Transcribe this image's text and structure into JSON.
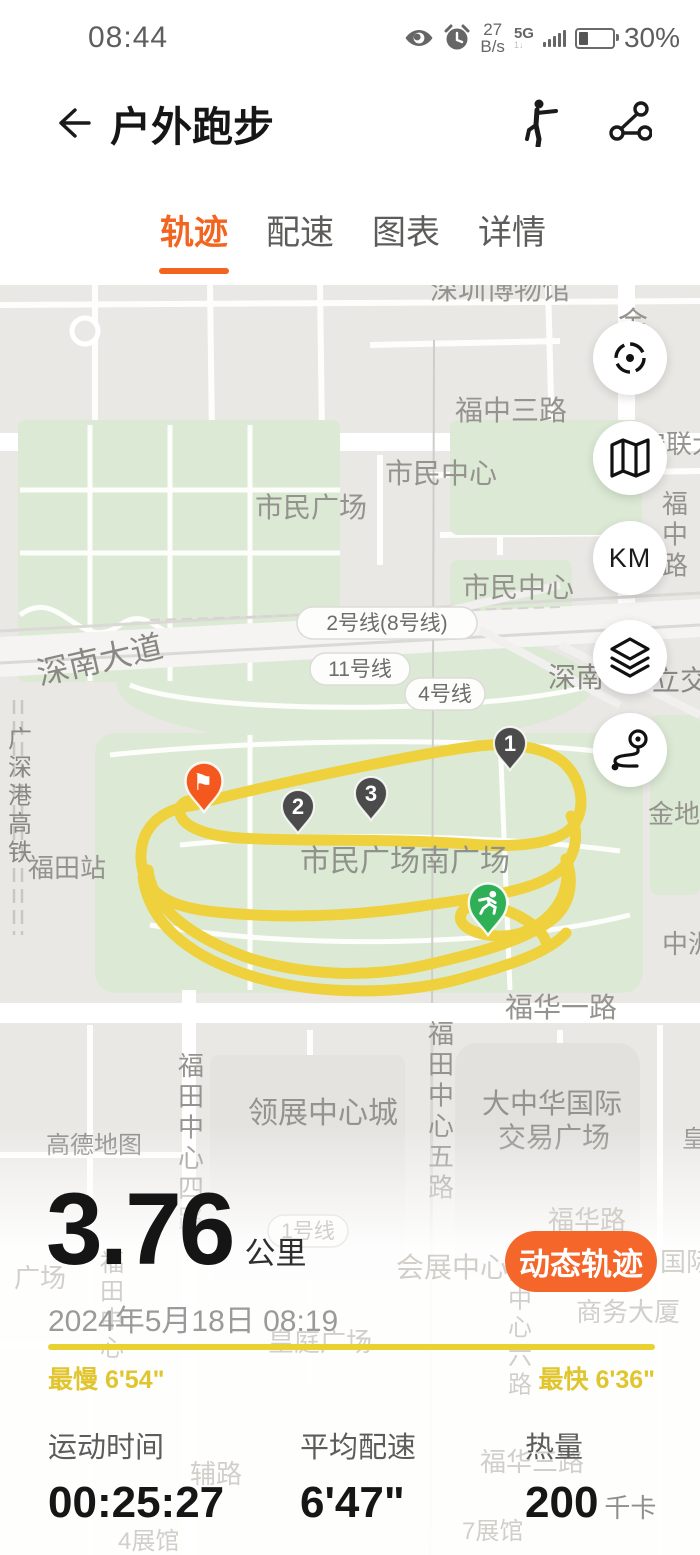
{
  "colors": {
    "accent": "#f2641f",
    "button_orange": "#f4662a",
    "track_yellow": "#eed13d",
    "pace_yellow": "#e0c52e",
    "pin_dark": "#4b4b4b",
    "pin_green": "#2fb057",
    "pin_flag": "#f5581f",
    "map_label": "#95938e",
    "map_label_faint": "#d2cfca"
  },
  "status_bar": {
    "time": "08:44",
    "net_value": "27",
    "net_unit": "B/s",
    "net_type": "5G",
    "battery_percent": "30%"
  },
  "header": {
    "title": "户外跑步"
  },
  "tabs": [
    {
      "label": "轨迹",
      "active": true
    },
    {
      "label": "配速",
      "active": false
    },
    {
      "label": "图表",
      "active": false
    },
    {
      "label": "详情",
      "active": false
    }
  ],
  "map": {
    "attribution": "高德地图",
    "km_button_label": "KM",
    "labels": [
      {
        "text": "深圳博物馆",
        "x": 430,
        "y": 14,
        "size": 28
      },
      {
        "text": "金",
        "x": 618,
        "y": 48,
        "size": 30
      },
      {
        "text": "福中三路",
        "x": 455,
        "y": 135,
        "size": 28
      },
      {
        "text": "安联大",
        "x": 640,
        "y": 168,
        "size": 26
      },
      {
        "text": "市民广场",
        "x": 255,
        "y": 232,
        "size": 28
      },
      {
        "text": "市民中心",
        "x": 385,
        "y": 198,
        "size": 28
      },
      {
        "text": "市民中心",
        "x": 462,
        "y": 312,
        "size": 28
      },
      {
        "text": "福中路",
        "x": 662,
        "y": 228,
        "size": 26,
        "vertical": true
      },
      {
        "text": "深南大道",
        "x": 40,
        "y": 400,
        "size": 32,
        "rotate": -13,
        "color": "#8a8883"
      },
      {
        "text": "深南",
        "x": 548,
        "y": 402,
        "size": 28,
        "color": "#8a8883"
      },
      {
        "text": "立交",
        "x": 652,
        "y": 405,
        "size": 28,
        "color": "#8a8883"
      },
      {
        "text": "广深港高铁",
        "x": 8,
        "y": 462,
        "size": 24,
        "vertical": true,
        "color": "#8a8883"
      },
      {
        "text": "福田站",
        "x": 28,
        "y": 592,
        "size": 26
      },
      {
        "text": "市民广场南广场",
        "x": 300,
        "y": 586,
        "size": 30,
        "color": "#8f928b"
      },
      {
        "text": "金地",
        "x": 648,
        "y": 538,
        "size": 26
      },
      {
        "text": "中洲",
        "x": 662,
        "y": 668,
        "size": 26
      },
      {
        "text": "福华一路",
        "x": 505,
        "y": 732,
        "size": 28
      },
      {
        "text": "福田中心四路",
        "x": 178,
        "y": 790,
        "size": 26,
        "vertical": true
      },
      {
        "text": "福田中心五路",
        "x": 428,
        "y": 758,
        "size": 26,
        "vertical": true
      },
      {
        "text": "领展中心城",
        "x": 248,
        "y": 838,
        "size": 30
      },
      {
        "text": "大中华国际",
        "x": 482,
        "y": 828,
        "size": 28
      },
      {
        "text": "交易广场",
        "x": 498,
        "y": 862,
        "size": 28
      },
      {
        "text": "高德地图",
        "x": 46,
        "y": 868,
        "size": 24,
        "color": "#8f8d89"
      },
      {
        "text": "皇",
        "x": 682,
        "y": 862,
        "size": 24
      },
      {
        "text": "会展中心",
        "x": 396,
        "y": 992,
        "size": 28,
        "faint": true
      },
      {
        "text": "福华路",
        "x": 548,
        "y": 944,
        "size": 26,
        "faint": true
      },
      {
        "text": "国际",
        "x": 660,
        "y": 986,
        "size": 26,
        "faint": true
      },
      {
        "text": "商务大厦",
        "x": 576,
        "y": 1036,
        "size": 26,
        "faint": true
      },
      {
        "text": "皇庭广场",
        "x": 268,
        "y": 1066,
        "size": 26,
        "faint": true
      },
      {
        "text": "广场",
        "x": 14,
        "y": 1002,
        "size": 26,
        "faint": true
      },
      {
        "text": "福田中心",
        "x": 100,
        "y": 986,
        "size": 24,
        "vertical": true,
        "faint": true
      },
      {
        "text": "田中心六路",
        "x": 508,
        "y": 994,
        "size": 24,
        "vertical": true,
        "faint": true
      },
      {
        "text": "福华三路",
        "x": 480,
        "y": 1186,
        "size": 26,
        "faint": true
      },
      {
        "text": "辅路",
        "x": 190,
        "y": 1198,
        "size": 26,
        "faint": true
      },
      {
        "text": "4展馆",
        "x": 118,
        "y": 1264,
        "size": 24,
        "faint": true
      },
      {
        "text": "7展馆",
        "x": 462,
        "y": 1254,
        "size": 24,
        "faint": true
      }
    ],
    "transit_badges": [
      {
        "text": "2号线(8号线)",
        "x": 297,
        "y": 322
      },
      {
        "text": "11号线",
        "x": 310,
        "y": 368
      },
      {
        "text": "4号线",
        "x": 405,
        "y": 393
      },
      {
        "text": "1号线",
        "x": 268,
        "y": 930,
        "faint": true
      }
    ],
    "km_marks": [
      {
        "label": "1",
        "x": 510,
        "y": 485
      },
      {
        "label": "2",
        "x": 298,
        "y": 548
      },
      {
        "label": "3",
        "x": 371,
        "y": 535
      }
    ],
    "start_flag": {
      "x": 204,
      "y": 527,
      "glyph": "⚑"
    },
    "current_position": {
      "x": 488,
      "y": 650
    }
  },
  "summary": {
    "distance_value": "3.76",
    "distance_unit": "公里",
    "action_button": "动态轨迹",
    "datetime": "2024年5月18日 08:19",
    "slowest": "最慢 6'54\"",
    "fastest": "最快 6'36\""
  },
  "stats": [
    {
      "label": "运动时间",
      "value": "00:25:27",
      "unit": ""
    },
    {
      "label": "平均配速",
      "value": "6'47\"",
      "unit": ""
    },
    {
      "label": "热量",
      "value": "200",
      "unit": "千卡"
    }
  ]
}
